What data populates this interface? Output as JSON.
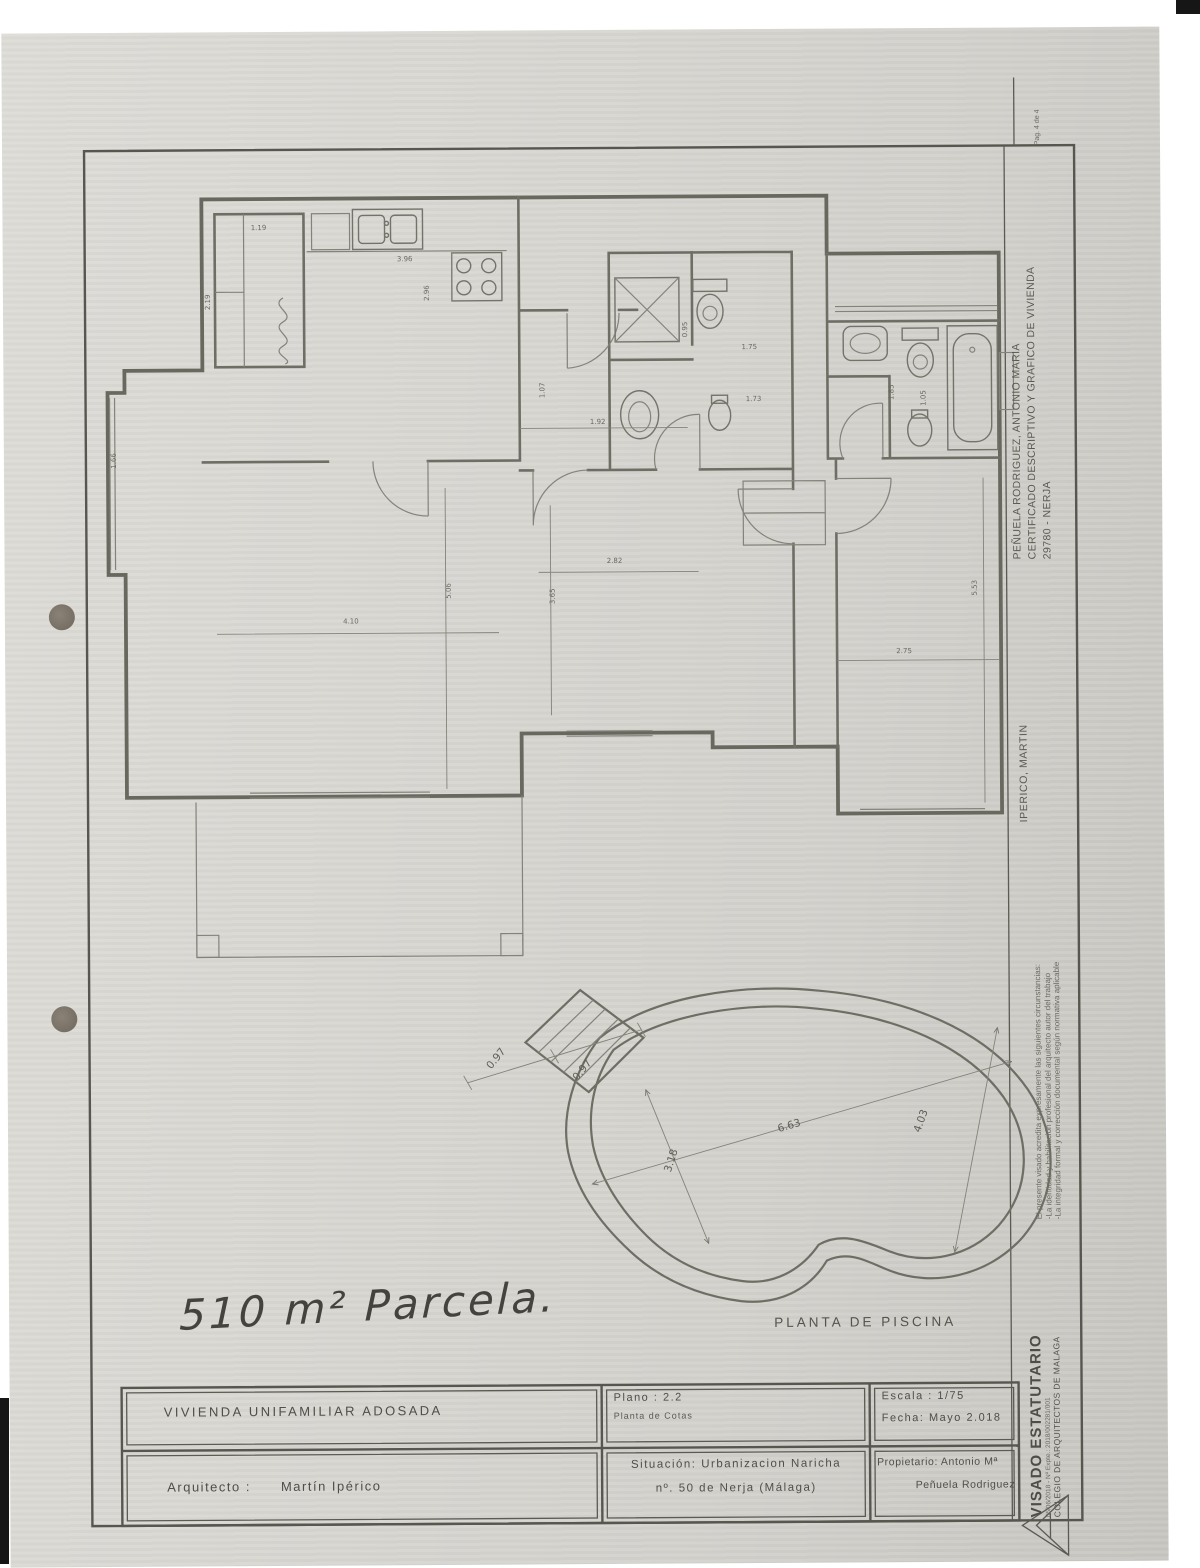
{
  "page": {
    "handwritten_note": "510 m² Parcela.",
    "pag_note": "Pag. 4 de 4"
  },
  "plan": {
    "pool_label": "PLANTA DE PISCINA",
    "dimensions": [
      {
        "text": "1.19",
        "x": 262,
        "y": 228,
        "rot": 0
      },
      {
        "text": "2.19",
        "x": 213,
        "y": 300,
        "rot": -90
      },
      {
        "text": "3.96",
        "x": 408,
        "y": 260,
        "rot": 0
      },
      {
        "text": "2.96",
        "x": 432,
        "y": 292,
        "rot": -90
      },
      {
        "text": "0.95",
        "x": 690,
        "y": 330,
        "rot": -90
      },
      {
        "text": "1.75",
        "x": 752,
        "y": 350,
        "rot": 0
      },
      {
        "text": "1.73",
        "x": 756,
        "y": 402,
        "rot": 0
      },
      {
        "text": "1.07",
        "x": 547,
        "y": 390,
        "rot": -90
      },
      {
        "text": "1.92",
        "x": 600,
        "y": 424,
        "rot": 0
      },
      {
        "text": "1.85",
        "x": 896,
        "y": 394,
        "rot": -90
      },
      {
        "text": "1.05",
        "x": 928,
        "y": 400,
        "rot": -90
      },
      {
        "text": "2.82",
        "x": 616,
        "y": 563,
        "rot": 0
      },
      {
        "text": "3.65",
        "x": 556,
        "y": 596,
        "rot": -90
      },
      {
        "text": "4.10",
        "x": 352,
        "y": 622,
        "rot": 0
      },
      {
        "text": "5.06",
        "x": 452,
        "y": 590,
        "rot": -90
      },
      {
        "text": "2.75",
        "x": 905,
        "y": 655,
        "rot": 0
      },
      {
        "text": "5.53",
        "x": 978,
        "y": 590,
        "rot": -90
      },
      {
        "text": "1.66",
        "x": 118,
        "y": 458,
        "rot": -90
      }
    ],
    "pool_dimensions": [
      {
        "text": "0.97",
        "x": 497,
        "y": 1060,
        "rot": -50,
        "lg": true
      },
      {
        "text": "0.97",
        "x": 583,
        "y": 1072,
        "rot": -50,
        "lg": true
      },
      {
        "text": "6.63",
        "x": 788,
        "y": 1130,
        "rot": -16,
        "lg": true
      },
      {
        "text": "4.03",
        "x": 922,
        "y": 1124,
        "rot": -70,
        "lg": true
      },
      {
        "text": "3.18",
        "x": 672,
        "y": 1162,
        "rot": -72,
        "lg": true
      }
    ]
  },
  "title_block": {
    "project": "VIVIENDA UNIFAMILIAR ADOSADA",
    "architect_label": "Arquitecto :",
    "architect_name": "Martín Ipérico",
    "plano_line1": "Plano : 2.2",
    "plano_line2": "Planta de Cotas",
    "escala": "Escala : 1/75",
    "fecha": "Fecha: Mayo 2.018",
    "situacion_line1": "Situación: Urbanizacion Naricha",
    "situacion_line2": "nº. 50 de Nerja (Málaga)",
    "propietario_line1": "Propietario: Antonio Mª",
    "propietario_line2": "Peñuela Rodriguez"
  },
  "margin": {
    "owner_line1": "PEÑUELA RODRIGUEZ, ANTONIO MARIA",
    "owner_line2": "CERTIFICADO DESCRIPTIVO Y GRAFICO DE VIVIENDA",
    "owner_line3": "29780 - NERJA",
    "architect": "IPERICO, MARTIN",
    "visado_line1": "El presente visado acredita expresamente las siguientes circunstancias:",
    "visado_line2": "-La identidad y habilitación profesional del arquitecto autor del trabajo",
    "visado_line3": "-La integridad formal y corrección documental según normativa aplicable",
    "visado_title": "VISADO ESTATUTARIO",
    "visado_ref": "05/06/2018 - Nº Expte.: 2018/002281/001",
    "colegio": "COLEGIO DE ARQUITECTOS DE MALAGA"
  }
}
